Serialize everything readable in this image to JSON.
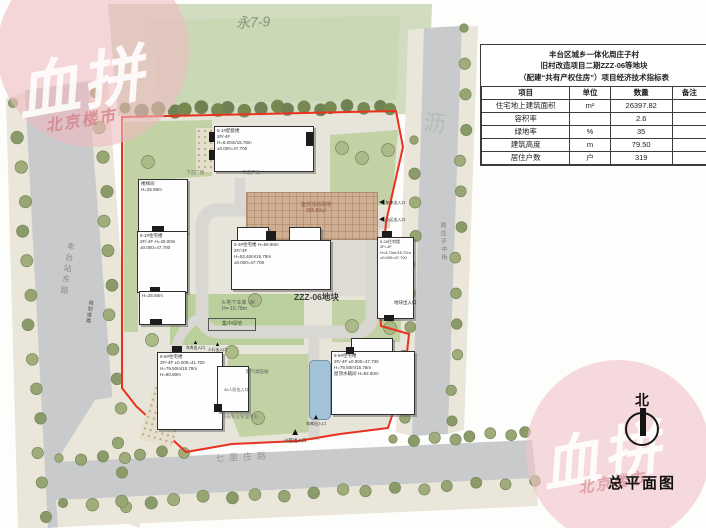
{
  "colors": {
    "boundary": "#e8311f",
    "road": "#c9cacc",
    "sidewalk": "#eae6d9",
    "park": "#d2dcc0",
    "lawn": "#c3d2a4",
    "site_base": "#e7e4da",
    "pool": "#a3c2d8",
    "activity_brown": "#cfae92",
    "watermark_pink": "#eebac0"
  },
  "icons": {
    "entrance_up": "▲",
    "entrance_left": "◀"
  },
  "park": {
    "label": "永7-9"
  },
  "parcel": {
    "label": "ZZZ-06地块"
  },
  "roads": {
    "west": "丰台站东路",
    "west_small": "规划道路",
    "south": "七里庄路",
    "east": "周庄子中街",
    "faint_char": "沥"
  },
  "table": {
    "title_lines": [
      "丰台区城乡一体化周庄子村",
      "旧村改造项目二期ZZZ-06等地块",
      "（配建“共有产权住房”）项目经济技术指标表"
    ],
    "headers": [
      "项目",
      "单位",
      "数量",
      "备注"
    ],
    "rows": [
      [
        "住宅地上建筑面积",
        "m²",
        "26397.82",
        ""
      ],
      [
        "容积率",
        "",
        "2.6",
        ""
      ],
      [
        "绿地率",
        "%",
        "35",
        ""
      ],
      [
        "建筑高度",
        "m",
        "79.50",
        ""
      ],
      [
        "居住户数",
        "户",
        "319",
        ""
      ]
    ]
  },
  "buildings": [
    {
      "id": "b1",
      "label": "6-1#配套楼\n2F/-4F\nH=8.00m/15.78m\n±0.000=47.700"
    },
    {
      "id": "b2a",
      "label": "楼梯间\nH=25.90m"
    },
    {
      "id": "b2b",
      "label": "5-1#住宅楼\n2F/-4F H=40.00m\n±0.000=47.700"
    },
    {
      "id": "b2c",
      "label": "H=25.60m"
    },
    {
      "id": "b3",
      "label": "5-3#住宅楼  H=58.90m\n2F/-4F\nH=53.40m/15.78m\n±0.000=47.700"
    },
    {
      "id": "b4",
      "label": "5-2#住宅楼\n2F/-4F\nH=8.70m/15.70m\n±0.000=47.700"
    },
    {
      "id": "b5",
      "label": "5-6#住宅楼\n2F/-4F ±0.000=41.700\nH=79.50m/15.78m\nH=80.80m"
    },
    {
      "id": "b6",
      "label": "5-5#住宅楼\n2F/-4F ±0.000=47.700\nH=79.50m/15.78m\n屋顶水箱间 H=82.60m"
    }
  ],
  "site_labels": {
    "sunken_plaza_1": "下沉广场",
    "sunken_plaza_2": "下沉广场",
    "activity_area": "室外活动场地\n255.50㎡",
    "garage": "6-地下车库 -3F\nH=-15.78m",
    "central_green": "集中绿地",
    "gas_station": "燃气调压站",
    "property_room": "四层物业管理用房",
    "civil_defense": "3#人防出入口"
  },
  "entrances": [
    {
      "label": "车库出入口"
    },
    {
      "label": "小区出入口"
    },
    {
      "label": "车库出入口"
    },
    {
      "label": "小区出入口"
    },
    {
      "label": "车库出入口"
    },
    {
      "label": "人行出入口"
    },
    {
      "label": "地块出入口"
    }
  ],
  "watermark": {
    "main": "血拼",
    "sub": "北京楼市"
  },
  "compass": {
    "north_label": "北",
    "caption": "总平面图"
  }
}
